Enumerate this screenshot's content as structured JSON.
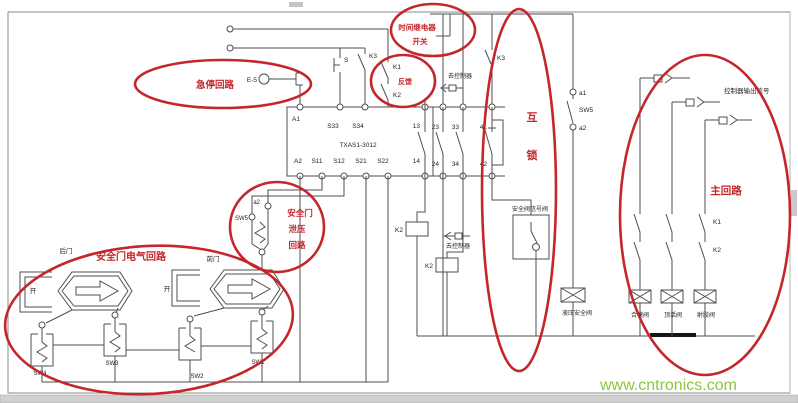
{
  "colors": {
    "annotation_red": "#c4262c",
    "wire": "#4f4f4f",
    "watermark_green": "#8cc63f"
  },
  "watermark": {
    "text": "www.cntronics.com"
  },
  "annotations": {
    "emergency_stop_loop": "急停回路",
    "reset_switch": {
      "line1": "时间继电器",
      "line2": "开关"
    },
    "feedback": "反馈",
    "interlock": {
      "char1": "互",
      "char2": "锁"
    },
    "door_relief": {
      "line1": "安全门",
      "line2": "泄压",
      "line3": "回路"
    },
    "door_electrical_loop": "安全门电气回路",
    "main_loop": "主回路"
  },
  "relay": {
    "model": "TXAS1-3012",
    "terminals": {
      "a1": "A1",
      "s33": "S33",
      "s34": "S34",
      "t13": "13",
      "a2": "A2",
      "s11": "S11",
      "s12": "S12",
      "s21": "S21",
      "s22": "S22",
      "t14": "14",
      "t23": "23",
      "t24": "24",
      "t33": "33",
      "t34": "34",
      "t41": "41",
      "t42": "42"
    }
  },
  "top_circuit": {
    "estop": "E-5",
    "start_button": "S",
    "k3_left": "K3",
    "k1": "K1",
    "k2": "K2",
    "k3_right": "K3",
    "to_controller": "去控制器"
  },
  "middle_circuit": {
    "k2_coil_a": "K2",
    "k2_coil_b": "K2",
    "to_controller": "去控制器",
    "safety_valve_signal": "安全阀信号阀",
    "a1": "a1",
    "sw5": "SW5",
    "a2": "a2",
    "hydraulic_safety_valve": "液压安全阀"
  },
  "door_circuit": {
    "rear_door": "后门",
    "front_door": "前门",
    "open_a": "开",
    "open_b": "开",
    "sw5": "SW5",
    "sw5_a2": "a2",
    "sw1": "SW1",
    "sw2": "SW2",
    "sw3": "SW3",
    "sw4": "SW4"
  },
  "main_circuit": {
    "output_signal": "控制器输出信号",
    "k1": "K1",
    "k2": "K2",
    "valve_close": "合模阀",
    "valve_eject": "顶活阀",
    "valve_inject": "射胶阀"
  }
}
